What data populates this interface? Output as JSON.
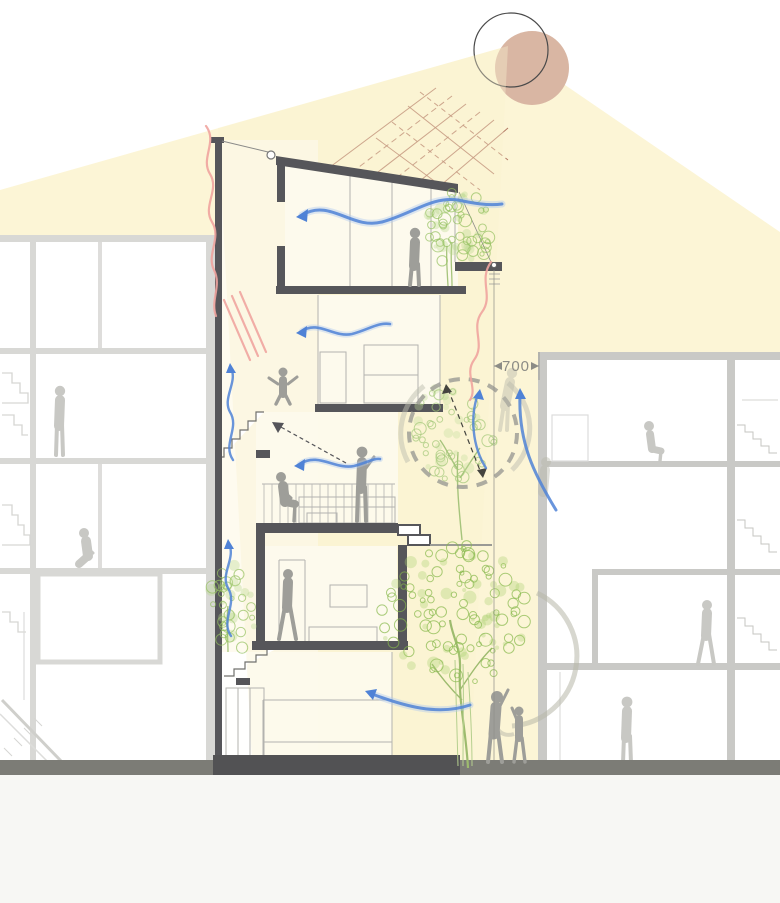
{
  "scene": {
    "type": "architectural-section-diagram",
    "title": "passive design section — sun, daylight and cross-ventilation study",
    "dimension": {
      "label": "700"
    },
    "palette": {
      "daylight_beam": "#fcf5d6",
      "sun_fill": "#d9b6a3",
      "sun_outline": "#4a4a4a",
      "sun_rays": "#a5624f",
      "structure_dark": "#56565a",
      "neighbor_gray": "#d2d2cf",
      "figure_gray": "#9e9e99",
      "wind_blue": "#4f82d6",
      "warm_air_pink": "#efa49e",
      "foliage_green": "#8cbb55",
      "ground_gray": "#7c7c76",
      "dimension_gray": "#8c8c86"
    },
    "elements": [
      "sun",
      "daylight-beam",
      "sun-rays",
      "main-house-section",
      "left-neighbor-building",
      "right-neighbor-building",
      "party-wall",
      "sloped-roof",
      "terrace-parapet",
      "interior-stairs",
      "courtyard-void-dashed-circle",
      "dimension-line-700",
      "garden-tree",
      "courtyard-tree",
      "terrace-tree",
      "small-side-tree",
      "ground-line"
    ],
    "figures": [
      "person-standing-top-floor",
      "child-jumping-second-floor",
      "person-sitting-on-bench",
      "person-standing-mezzanine",
      "person-walking-ground-floor",
      "adult-waving-garden",
      "child-waving-garden",
      "person-standing-left-building",
      "person-crouching-left-building",
      "person-sitting-right-building",
      "person-walking-right-building",
      "person-standing-right-building",
      "ghost-person-courtyard",
      "ghost-person-gap"
    ],
    "airflow": {
      "wind_arrows_blue": [
        "top-floor-cross-breeze",
        "second-floor-breeze",
        "mezzanine-breeze",
        "ground-floor-garden-breeze",
        "courtyard-updraft",
        "gap-updraft",
        "stair-void-updraft-upper",
        "stair-void-updraft-lower"
      ],
      "warm_air_pink": [
        "party-wall-stack-exhaust",
        "terrace-stack-exhaust"
      ]
    }
  }
}
